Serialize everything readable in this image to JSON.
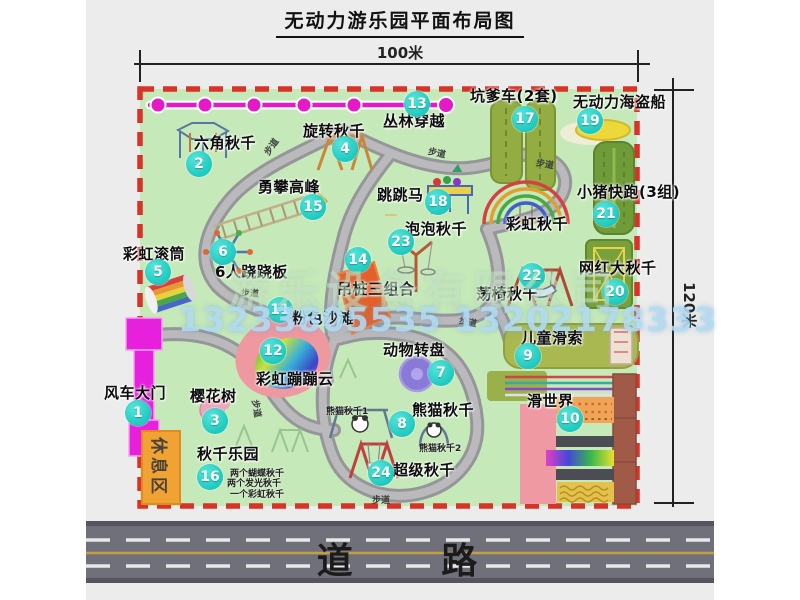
{
  "title": "无动力游乐园平面布局图",
  "dimension_labels": {
    "top": "100米",
    "right": "120米"
  },
  "road": {
    "label": "道 路"
  },
  "rest_area": {
    "label": "休息区"
  },
  "watermark": {
    "company": "游乐设备有限公司",
    "phone": "13233805535 13202178333"
  },
  "colors": {
    "park_green": "#c6e9b9",
    "border_red": "#d93327",
    "path_gray": "#96969a",
    "badge_teal": "#1fc9bf",
    "zipline_magenta": "#e41ac8",
    "gate_magenta": "#e620dc",
    "rest_orange": "#f0a233",
    "road_gray": "#70707a",
    "road_line_yellow": "#c2a040",
    "beach_pink": "#ee98a0",
    "carousel_purple": "#8a7ad8",
    "ship_yellow": "#ecd83a",
    "mat_olive": "#93ad43",
    "slide_brown": "#a25a48",
    "watermark_blue": "#b4dcf2"
  },
  "map": {
    "attractions": [
      {
        "id": "windmill-gate",
        "num": "1",
        "label": "风车大门",
        "badge": [
          138,
          413
        ],
        "label_pos": [
          104,
          386
        ]
      },
      {
        "id": "hexagon-swing",
        "num": "2",
        "label": "六角秋千",
        "badge": [
          199,
          164
        ],
        "label_pos": [
          194,
          136
        ]
      },
      {
        "id": "cherry-tree",
        "num": "3",
        "label": "樱花树",
        "badge": [
          215,
          421
        ],
        "label_pos": [
          190,
          389
        ]
      },
      {
        "id": "rotating-swing",
        "num": "4",
        "label": "旋转秋千",
        "badge": [
          345,
          149
        ],
        "label_pos": [
          303,
          124
        ]
      },
      {
        "id": "rainbow-roller",
        "num": "5",
        "label": "彩虹滚筒",
        "badge": [
          158,
          272
        ],
        "label_pos": [
          123,
          247
        ]
      },
      {
        "id": "six-person-seesaw",
        "num": "6",
        "label": "6人跷跷板",
        "badge": [
          223,
          252
        ],
        "label_pos": [
          215,
          265
        ]
      },
      {
        "id": "animal-carousel",
        "num": "7",
        "label": "动物转盘",
        "badge": [
          441,
          373
        ],
        "label_pos": [
          383,
          343
        ]
      },
      {
        "id": "panda-swing",
        "num": "8",
        "label": "熊猫秋千",
        "badge": [
          402,
          424
        ],
        "label_pos": [
          412,
          403
        ]
      },
      {
        "id": "kids-zipline",
        "num": "9",
        "label": "儿童滑索",
        "badge": [
          528,
          356
        ],
        "label_pos": [
          521,
          331
        ]
      },
      {
        "id": "slide-world",
        "num": "10",
        "label": "滑世界",
        "badge": [
          570,
          419
        ],
        "label_pos": [
          527,
          394
        ]
      },
      {
        "id": "pink-beach",
        "num": "11",
        "label": "粉色沙滩",
        "badge": [
          280,
          310
        ],
        "label_pos": [
          292,
          311
        ]
      },
      {
        "id": "rainbow-bounce-cloud",
        "num": "12",
        "label": "彩虹蹦蹦云",
        "badge": [
          273,
          351
        ],
        "label_pos": [
          256,
          372
        ]
      },
      {
        "id": "jungle-crossing",
        "num": "13",
        "label": "丛林穿越",
        "badge": [
          417,
          104
        ],
        "label_pos": [
          383,
          114
        ]
      },
      {
        "id": "hanging-piles-combo",
        "num": "14",
        "label": "吊桩三组合",
        "badge": [
          358,
          260
        ],
        "label_pos": [
          337,
          282
        ]
      },
      {
        "id": "peak-climbing",
        "num": "15",
        "label": "勇攀高峰",
        "badge": [
          313,
          207
        ],
        "label_pos": [
          258,
          180
        ]
      },
      {
        "id": "swing-park",
        "num": "16",
        "label": "秋千乐园",
        "badge": [
          210,
          477
        ],
        "label_pos": [
          197,
          447
        ]
      },
      {
        "id": "pit-cart",
        "num": "17",
        "label": "坑爹车(2套)",
        "badge": [
          525,
          119
        ],
        "label_pos": [
          470,
          89
        ]
      },
      {
        "id": "jumping-horse",
        "num": "18",
        "label": "跳跳马",
        "badge": [
          438,
          202
        ],
        "label_pos": [
          377,
          188
        ]
      },
      {
        "id": "pirate-ship",
        "num": "19",
        "label": "无动力海盗船",
        "badge": [
          590,
          121
        ],
        "label_pos": [
          573,
          95
        ]
      },
      {
        "id": "big-swing",
        "num": "20",
        "label": "网红大秋千",
        "badge": [
          615,
          292
        ],
        "label_pos": [
          579,
          261
        ]
      },
      {
        "id": "piggy-run",
        "num": "21",
        "label": "小猪快跑(3组)",
        "badge": [
          606,
          214
        ],
        "label_pos": [
          577,
          185
        ]
      },
      {
        "id": "swing-chair",
        "num": "22",
        "label": "荡椅秋千",
        "badge": [
          532,
          276
        ],
        "label_pos": [
          476,
          287
        ]
      },
      {
        "id": "bubble-swing",
        "num": "23",
        "label": "泡泡秋千",
        "badge": [
          401,
          242
        ],
        "label_pos": [
          405,
          222
        ]
      },
      {
        "id": "super-swing",
        "num": "24",
        "label": "超级秋千",
        "badge": [
          381,
          473
        ],
        "label_pos": [
          393,
          463
        ]
      },
      {
        "id": "rainbow-swing",
        "num": "",
        "label": "彩虹秋千",
        "badge": null,
        "label_pos": [
          506,
          217
        ]
      }
    ],
    "sub_labels": [
      {
        "text": "熊猫秋千1",
        "pos": [
          326,
          404
        ]
      },
      {
        "text": "熊猫秋千2",
        "pos": [
          419,
          441
        ]
      },
      {
        "text": "两个蝴蝶秋千",
        "pos": [
          230,
          466
        ]
      },
      {
        "text": "两个发光秋千",
        "pos": [
          227,
          476
        ]
      },
      {
        "text": "一个彩虹秋千",
        "pos": [
          230,
          487
        ]
      }
    ],
    "path_labels": [
      {
        "text": "步道",
        "pos": [
          262,
          140
        ],
        "rot": -55
      },
      {
        "text": "步道",
        "pos": [
          428,
          146
        ],
        "rot": 12
      },
      {
        "text": "步道",
        "pos": [
          536,
          157
        ],
        "rot": 10
      },
      {
        "text": "步道",
        "pos": [
          241,
          286
        ],
        "rot": 4
      },
      {
        "text": "步道",
        "pos": [
          248,
          402
        ],
        "rot": 80
      },
      {
        "text": "步道",
        "pos": [
          459,
          315
        ],
        "rot": 12
      },
      {
        "text": "步道",
        "pos": [
          372,
          493
        ],
        "rot": 0
      }
    ]
  }
}
